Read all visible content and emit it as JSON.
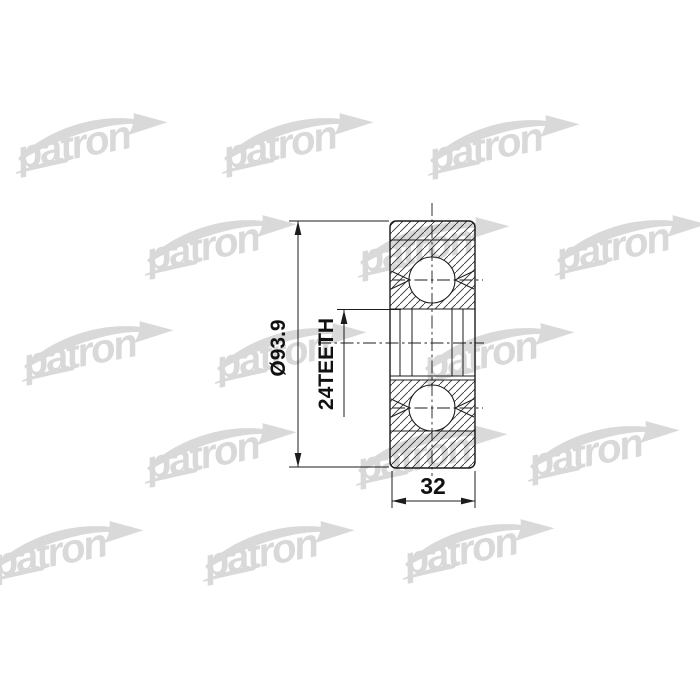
{
  "canvas": {
    "width": 700,
    "height": 700,
    "background_color": "#ffffff",
    "line_color": "#1c1c1c"
  },
  "watermark": {
    "text": "patron",
    "color": "#d9d9d9"
  },
  "drawing": {
    "kind": "cv-joint-cross-section-technical-drawing",
    "dimensions": {
      "outer_diameter": "Ø93.9",
      "spline_teeth": "24TEETH",
      "body_width": "32"
    }
  }
}
